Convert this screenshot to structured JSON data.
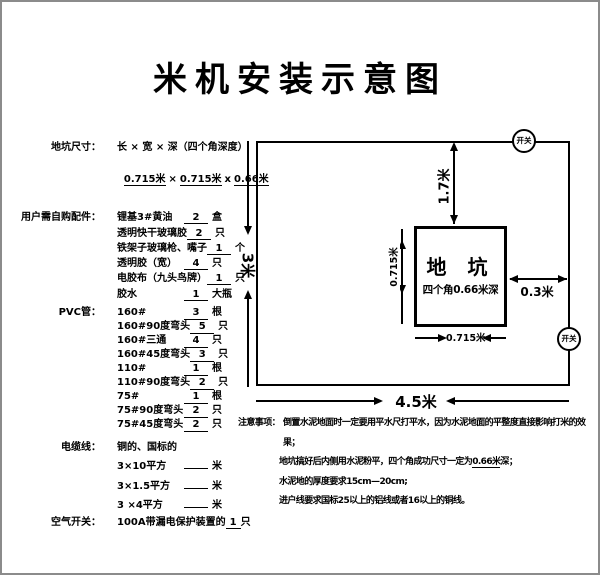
{
  "title": "米机安装示意图",
  "left_panel": {
    "pit_size": {
      "label": "地坑尺寸：",
      "formula": "长 × 宽 × 深（四个角深度）",
      "dim1": "0.715米",
      "sep1": "×",
      "dim2": "0.715米",
      "sep2": "x",
      "dim3": "0.66米"
    },
    "parts": {
      "label": "用户需自购配件：",
      "items": [
        {
          "name": "锂基3#黄油",
          "qty": "2",
          "unit": "盒"
        },
        {
          "name": "透明快干玻璃胶",
          "qty": "2",
          "unit": "只"
        },
        {
          "name": "铁架子玻璃枪、嘴子",
          "qty": "1",
          "unit": "个"
        },
        {
          "name": "透明胶（宽）",
          "qty": "4",
          "unit": "只"
        },
        {
          "name": "电胶布（九头鸟牌）",
          "qty": "1",
          "unit": "只"
        },
        {
          "name": "胶水",
          "qty": "1",
          "unit": "大瓶"
        }
      ]
    },
    "pvc": {
      "label": "PVC管：",
      "items": [
        {
          "name": "160#",
          "qty": "3",
          "unit": "根"
        },
        {
          "name": "160#90度弯头",
          "qty": "5",
          "unit": "只"
        },
        {
          "name": "160#三通",
          "qty": "4",
          "unit": "只"
        },
        {
          "name": "160#45度弯头",
          "qty": "3",
          "unit": "只"
        },
        {
          "name": "110#",
          "qty": "1",
          "unit": "根"
        },
        {
          "name": "110#90度弯头",
          "qty": "2",
          "unit": "只"
        },
        {
          "name": "75#",
          "qty": "1",
          "unit": "根"
        },
        {
          "name": "75#90度弯头",
          "qty": "2",
          "unit": "只"
        },
        {
          "name": "75#45度弯头",
          "qty": "2",
          "unit": "只"
        }
      ]
    },
    "cable": {
      "label": "电缆线：",
      "spec": "铜的、国标的",
      "items": [
        {
          "name": "3×10平方",
          "qty": "",
          "unit": "米"
        },
        {
          "name": "3×1.5平方",
          "qty": "",
          "unit": "米"
        },
        {
          "name": "3 ×4平方",
          "qty": "",
          "unit": "米"
        }
      ]
    },
    "air_switch": {
      "label": "空气开关：",
      "text": "100A带漏电保护装置的",
      "qty": "1",
      "unit": "只"
    }
  },
  "diagram": {
    "room_width_label": "4.5米",
    "room_height_label": "3米",
    "switch_top_label": "开关",
    "switch_right_label": "开关",
    "pit_title": "地 坑",
    "pit_subtitle": "四个角0.66米深",
    "pit_width_label": "0.715米",
    "pit_height_label": "0.715米",
    "dist_top_label": "1.7米",
    "dist_right_label": "0.3米"
  },
  "notes": {
    "label": "注意事项：",
    "line1": "倒置水泥地面时一定要用平水尺打平水，因为水泥地面的平整度直接影响打米的效果；",
    "line2_pre": "地坑搞好后内侧用水泥粉平，四个角成功尺寸一定为",
    "line2_u": "0.66米",
    "line2_post": "深；",
    "line3": "水泥地的厚度要求15cm—20cm;",
    "line4": "进户线要求国标25以上的铝线或者16以上的铜线。"
  }
}
